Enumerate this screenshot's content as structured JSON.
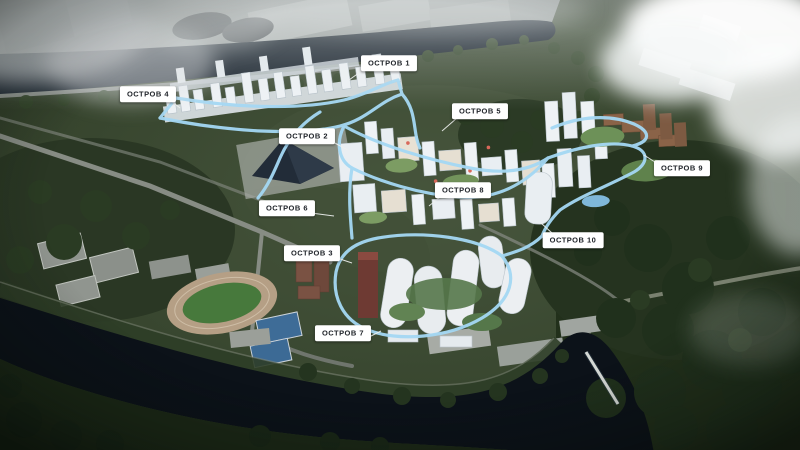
{
  "labels": [
    {
      "id": "ostrov-1",
      "text": "ОСТРОВ 1"
    },
    {
      "id": "ostrov-2",
      "text": "ОСТРОВ 2"
    },
    {
      "id": "ostrov-3",
      "text": "ОСТРОВ 3"
    },
    {
      "id": "ostrov-4",
      "text": "ОСТРОВ 4"
    },
    {
      "id": "ostrov-5",
      "text": "ОСТРОВ 5"
    },
    {
      "id": "ostrov-6",
      "text": "ОСТРОВ 6"
    },
    {
      "id": "ostrov-7",
      "text": "ОСТРОВ 7"
    },
    {
      "id": "ostrov-8",
      "text": "ОСТРОВ 8"
    },
    {
      "id": "ostrov-9",
      "text": "ОСТРОВ 9"
    },
    {
      "id": "ostrov-10",
      "text": "ОСТРОВ 10"
    }
  ],
  "colors": {
    "label_background": "#ffffff",
    "label_text": "#20242a",
    "route_highlight": "#a4d8f4",
    "river_water": "#0c1219",
    "forest_green": "#22301b",
    "land_green": "#37452e",
    "building_white": "#e9eef2",
    "building_brick": "#8a6348",
    "sports_field": "#47793c",
    "tennis_court": "#3e6c97"
  }
}
